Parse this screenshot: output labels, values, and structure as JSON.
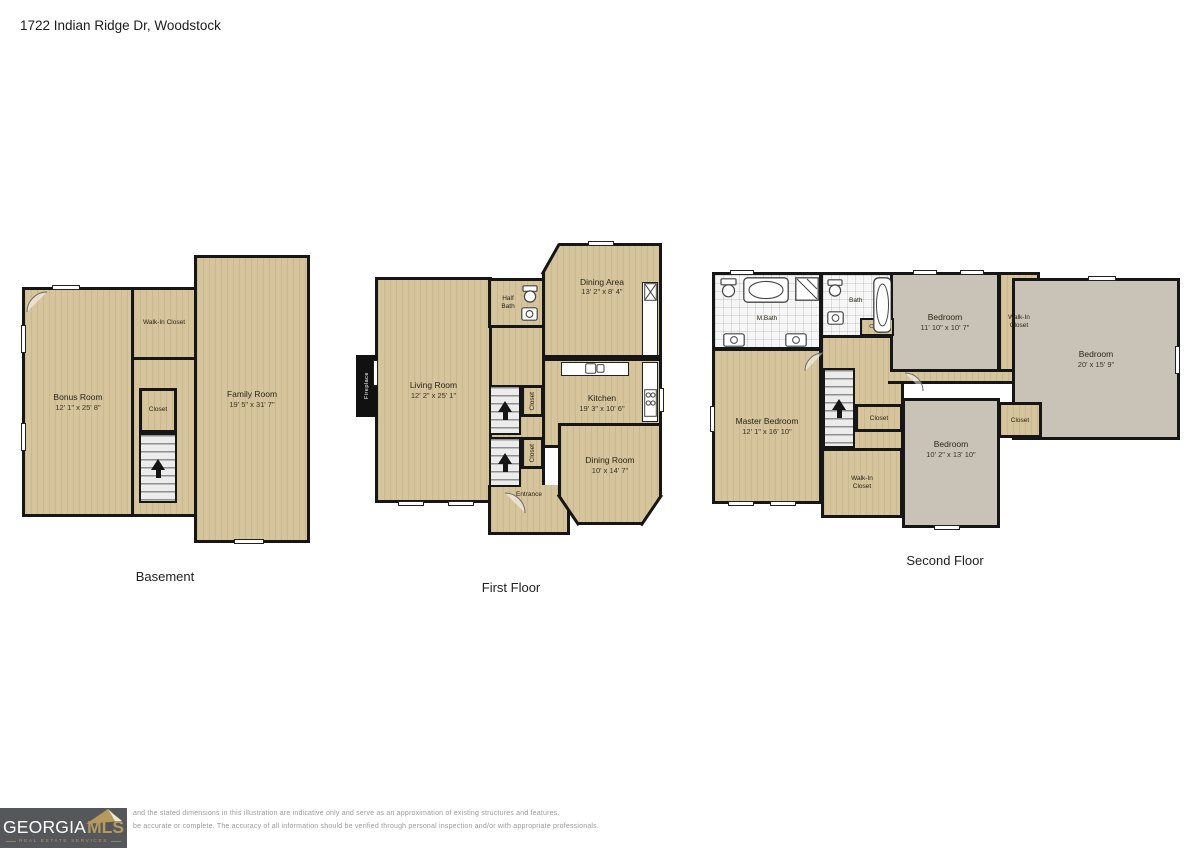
{
  "title": "1722 Indian Ridge Dr, Woodstock",
  "colors": {
    "wood_floor": "#d5c49c",
    "carpet_floor": "#c9c3b7",
    "tile_floor": "#f6f6f6",
    "wall": "#161616",
    "logo_bg": "#55575a",
    "logo_gold": "#b59a5f",
    "disclaimer_text": "#9b9b9b"
  },
  "icons": [
    "stairs-up-arrow",
    "toilet",
    "bathtub",
    "shower",
    "sink",
    "stove",
    "fireplace",
    "roof-logo",
    "door-arc",
    "window"
  ],
  "floors": {
    "basement": {
      "label": "Basement",
      "rooms": {
        "bonus": {
          "name": "Bonus Room",
          "dims": "12' 1\" x 25' 8\""
        },
        "walkin": {
          "name": "Walk-In Closet"
        },
        "closet": {
          "name": "Closet"
        },
        "family": {
          "name": "Family Room",
          "dims": "19' 5\" x 31' 7\""
        }
      }
    },
    "first": {
      "label": "First Floor",
      "rooms": {
        "living": {
          "name": "Living Room",
          "dims": "12' 2\" x 25' 1\""
        },
        "fireplace": {
          "name": "Fireplace"
        },
        "half_bath": {
          "name": "Half Bath"
        },
        "dining_area": {
          "name": "Dining Area",
          "dims": "13' 2\" x 8' 4\""
        },
        "kitchen": {
          "name": "Kitchen",
          "dims": "19' 3\" x 10' 6\""
        },
        "closet_upper": {
          "name": "Closet"
        },
        "closet_lower": {
          "name": "Closet"
        },
        "entrance": {
          "name": "Entrance"
        },
        "dining_room": {
          "name": "Dining Room",
          "dims": "10' x 14' 7\""
        }
      }
    },
    "second": {
      "label": "Second Floor",
      "rooms": {
        "m_bath": {
          "name": "M.Bath"
        },
        "bath": {
          "name": "Bath"
        },
        "closet_top": {
          "name": "Closet"
        },
        "bedroom_top": {
          "name": "Bedroom",
          "dims": "11' 10\" x 10' 7\""
        },
        "walkin_top": {
          "name": "Walk-In Closet"
        },
        "bedroom_right": {
          "name": "Bedroom",
          "dims": "20' x 15' 9\""
        },
        "master": {
          "name": "Master Bedroom",
          "dims": "12' 1\" x 16' 10\""
        },
        "closet_mid": {
          "name": "Closet"
        },
        "closet_right": {
          "name": "Closet"
        },
        "bedroom_bottom": {
          "name": "Bedroom",
          "dims": "10' 2\" x 13' 10\""
        },
        "walkin_bottom": {
          "name": "Walk-In Closet"
        }
      }
    }
  },
  "footer": {
    "logo": {
      "brand_primary": "GEORGIA",
      "brand_secondary": "MLS",
      "tagline": "REAL ESTATE SERVICES"
    },
    "disclaimer_line1": "and the stated dimensions in this illustration are indicative only and serve as an approximation of existing structures and features.",
    "disclaimer_line2": "be accurate or complete. The accuracy of all information should be verified through personal inspection and/or with appropriate professionals."
  }
}
